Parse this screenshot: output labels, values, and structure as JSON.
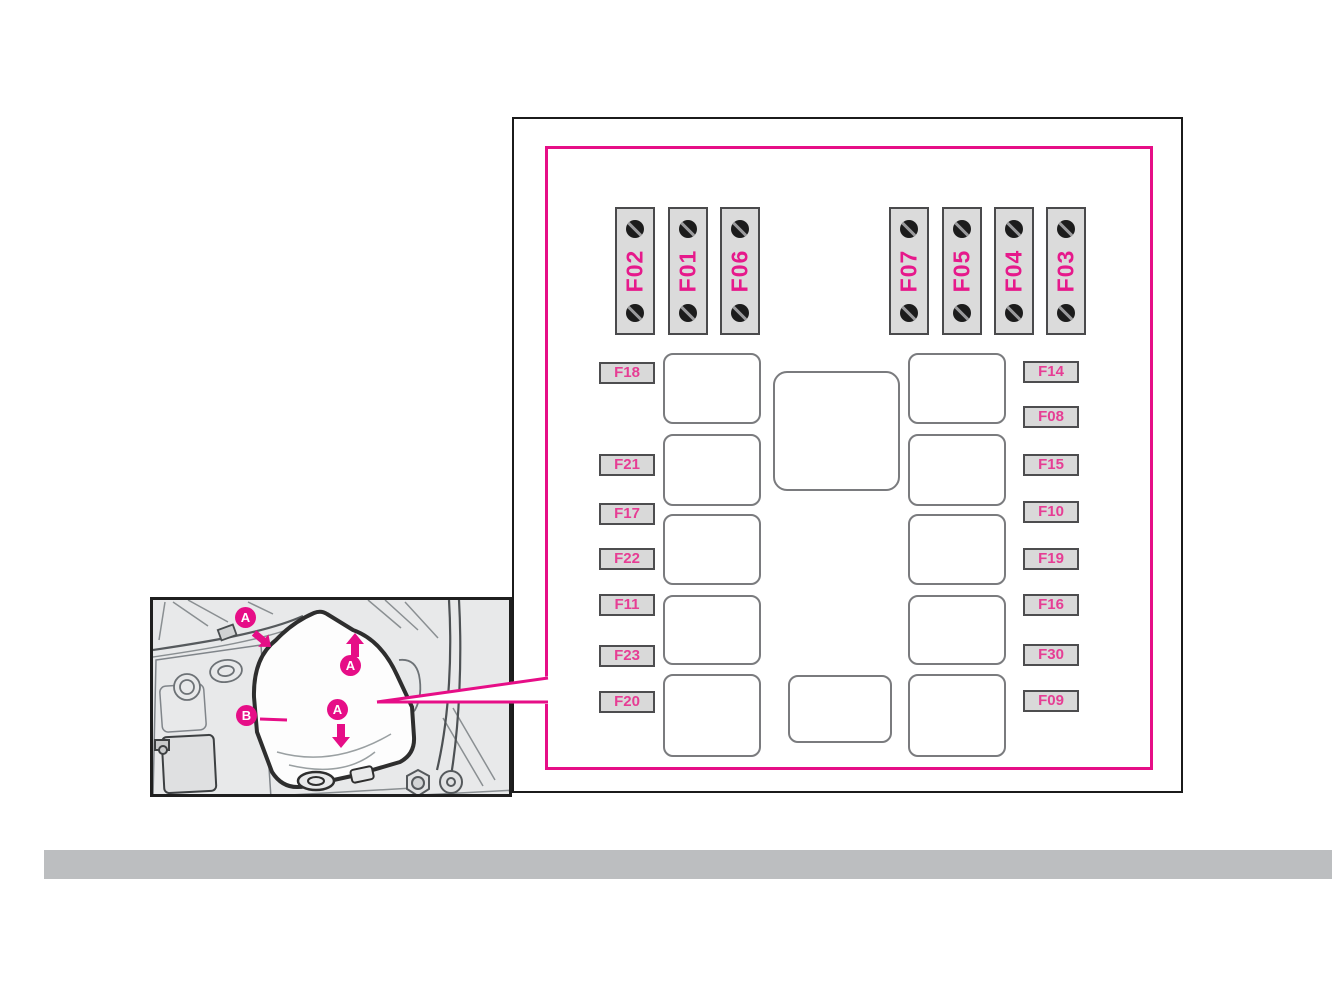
{
  "colors": {
    "accent": "#e60e87",
    "strip_label_text": "#e6198b",
    "fuse_label_text": "#e63d94",
    "inset_background": "#e8e9ea",
    "footer_bar": "#bcbec0"
  },
  "fusebox_diagram": {
    "strips_left": [
      "F02",
      "F01",
      "F06"
    ],
    "strips_right": [
      "F07",
      "F05",
      "F04",
      "F03"
    ],
    "labels_left": [
      "F18",
      "F21",
      "F17",
      "F22",
      "F11",
      "F23",
      "F20"
    ],
    "labels_right": [
      "F14",
      "F08",
      "F15",
      "F10",
      "F19",
      "F16",
      "F30",
      "F09"
    ]
  },
  "cover_inset": {
    "markers": {
      "top_left": "A",
      "lift_up": "A",
      "press_down": "A",
      "cover": "B"
    },
    "icons": {
      "screw": "screw-icon",
      "arrow_up": "arrow-up-icon",
      "arrow_down": "arrow-down-icon",
      "arrow_down_right": "arrow-down-right-icon",
      "callout": "callout-wedge-icon"
    }
  }
}
